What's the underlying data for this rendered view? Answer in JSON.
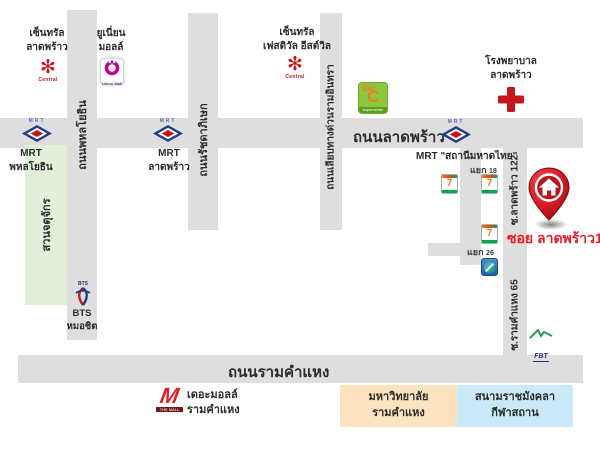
{
  "title": "Soi Ladprao 122 direction map",
  "roads": {
    "phahonyothin": "ถนนพหลโยธิน",
    "ratchadaphisek": "ถนนรัชดาภิเษก",
    "ramindra_expressway": "ถนนเลียบทางด่วนรามอินทรา",
    "ladprao": "ถนนลาดพร้าว",
    "soi_ladprao_122": "ซ.ลาดพร้าว 122",
    "soi_ramkhamhaeng_65": "ซ.รามคำแหง 65",
    "ramkhamhaeng": "ถนนรามคำแหง"
  },
  "stations": {
    "mrt_phahonyothin": "MRT\nพหลโยธิน",
    "mrt_ladprao": "MRT\nลาดพร้าว",
    "mrt_mahatthai": "MRT  \"สถานีมหาดไทย\"",
    "bts_mochit": "BTS\nหมอชิต"
  },
  "landmarks": {
    "central_ladprao": "เซ็นทรัล\nลาดพร้าว",
    "union_mall": "ยูเนี่ยน\nมอลล์",
    "central_eastville": "เซ็นทรัล\nเฟสติวัล อีสต์วิล",
    "hospital_ladprao": "โรงพยาบาล\nลาดพร้าว",
    "chatuchak_park": "สวนจตุจักร",
    "the_mall_ramkhamhaeng": "เดอะมอลล์\nรามคำแหง",
    "ramkhamhaeng_university": "มหาวิทยาลัย\nรามคำแหง",
    "rajamangala_stadium": "สนามราชมังคลา\nกีฬาสถาน"
  },
  "intersections": {
    "yaek_18": {
      "word": "แยก",
      "num": "18"
    },
    "yaek_26": {
      "word": "แยก",
      "num": "26"
    }
  },
  "destination": {
    "label": "ซอย ลาดพร้าว122"
  },
  "logos": {
    "central_glyph": "✻",
    "central_word": "Central",
    "union_mall_word": "Union Mall",
    "big_c_big": "Big",
    "big_c_c": "C",
    "big_c_sub": "supercenter",
    "seven_eleven": "7",
    "mrt_word": "MRT",
    "fbt_word": "FBT",
    "the_mall_word": "THE MALL",
    "the_mall_m": "M"
  },
  "colors": {
    "road_gray": "#dedede",
    "park_green": "#e3efdb",
    "university_box": "#fce3c0",
    "stadium_box": "#c9e8f8",
    "brand_red": "#c4161c",
    "pin_red": "#d31a22",
    "destination_text": "#ec1c24",
    "big_c_green": "#8dc63f",
    "big_c_orange": "#f47b20",
    "mrt_blue": "#1f3c88",
    "union_mall_magenta": "#c4008f",
    "fbt_green": "#2e9e4f",
    "fbt_blue": "#28348a"
  }
}
